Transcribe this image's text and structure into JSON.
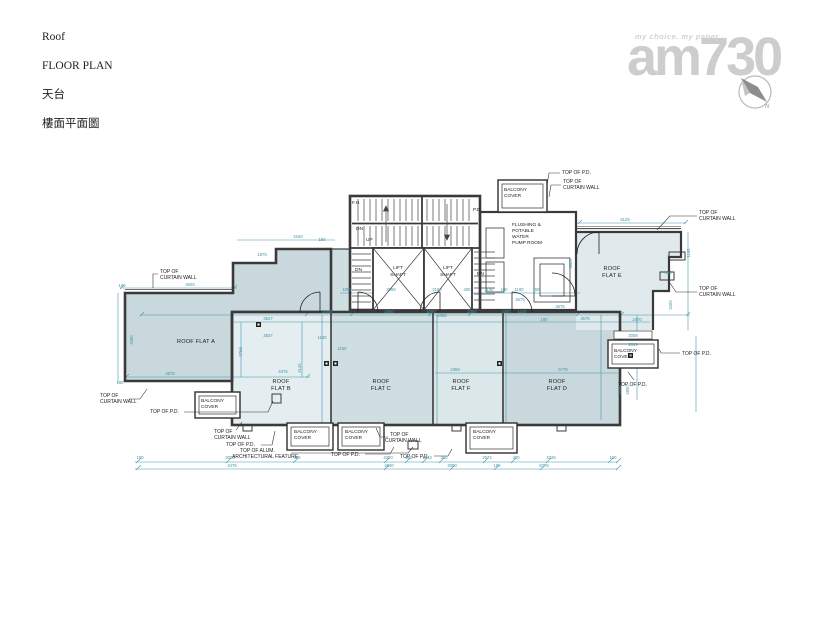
{
  "header": {
    "lines": [
      "Roof",
      "FLOOR PLAN",
      "天台",
      "樓面平面圖"
    ]
  },
  "watermark": {
    "tagline": "my choice. my paper",
    "brand": "am730",
    "compass_label": "N"
  },
  "labels": {
    "top_of_pd": "TOP OF P.D.",
    "top_of": "TOP OF",
    "curtain_wall": "CURTAIN WALL",
    "top_of_alum": "TOP OF ALUM.",
    "arch_feature": "ARCHITECTURAL FEATURE",
    "balcony": "BALCONY",
    "cover": "COVER",
    "lift": "LIFT",
    "shaft": "SHAFT",
    "dn": "DN",
    "up": "UP",
    "pd": "P.D.",
    "fh": "F.H.",
    "pump_room": [
      "FLUSHING &",
      "POTABLE",
      "WATER",
      "PUMP ROOM"
    ],
    "flat_a": "ROOF FLAT A",
    "roof": "ROOF",
    "flat_b": "FLAT B",
    "flat_c": "FLAT C",
    "flat_d": "FLAT D",
    "flat_e": "FLAT E",
    "flat_f": "FLAT F"
  },
  "colors": {
    "wall": "#3a3a3a",
    "dim": "#3f93a9",
    "fill_mid": "#c9d8dc",
    "fill_mid2": "#cfdee1",
    "fill_light": "#dce7ea",
    "fill_lighter": "#e4edef",
    "fill_e": "#e0eaec",
    "logo": "#cdcdcd"
  },
  "dims": [
    {
      "x": 190,
      "y": 286,
      "v": "4625"
    },
    {
      "x": 122,
      "y": 287,
      "v": "150"
    },
    {
      "x": 262,
      "y": 256,
      "v": "1875"
    },
    {
      "x": 298,
      "y": 238,
      "v": "2150"
    },
    {
      "x": 322,
      "y": 241,
      "v": "150"
    },
    {
      "x": 625,
      "y": 221,
      "v": "5125"
    },
    {
      "x": 347,
      "y": 291,
      "v": "1050"
    },
    {
      "x": 391,
      "y": 291,
      "v": "2050"
    },
    {
      "x": 437,
      "y": 291,
      "v": "2150"
    },
    {
      "x": 467,
      "y": 291,
      "v": "400"
    },
    {
      "x": 489,
      "y": 291,
      "v": "1100"
    },
    {
      "x": 504,
      "y": 291,
      "v": "100"
    },
    {
      "x": 519,
      "y": 291,
      "v": "1100"
    },
    {
      "x": 536,
      "y": 291,
      "v": "150"
    },
    {
      "x": 520,
      "y": 301,
      "v": "2675"
    },
    {
      "x": 560,
      "y": 308,
      "v": "4675"
    },
    {
      "x": 327,
      "y": 313,
      "v": "2088"
    },
    {
      "x": 389,
      "y": 313,
      "v": "3450"
    },
    {
      "x": 431,
      "y": 313,
      "v": "1000"
    },
    {
      "x": 472,
      "y": 313,
      "v": "3350"
    },
    {
      "x": 506,
      "y": 313,
      "v": "1000"
    },
    {
      "x": 522,
      "y": 313,
      "v": "1100"
    },
    {
      "x": 585,
      "y": 320,
      "v": "4575"
    },
    {
      "x": 544,
      "y": 321,
      "v": "100"
    },
    {
      "x": 268,
      "y": 320,
      "v": "3527"
    },
    {
      "x": 268,
      "y": 337,
      "v": "3537"
    },
    {
      "x": 170,
      "y": 375,
      "v": "4675"
    },
    {
      "x": 283,
      "y": 373,
      "v": "4475"
    },
    {
      "x": 301,
      "y": 368,
      "v": "4145",
      "r": 1
    },
    {
      "x": 242,
      "y": 352,
      "v": "2768",
      "r": 1
    },
    {
      "x": 133,
      "y": 340,
      "v": "4380",
      "r": 1
    },
    {
      "x": 120,
      "y": 384,
      "v": "150"
    },
    {
      "x": 322,
      "y": 339,
      "v": "1150"
    },
    {
      "x": 342,
      "y": 350,
      "v": "1150"
    },
    {
      "x": 637,
      "y": 321,
      "v": "2470"
    },
    {
      "x": 633,
      "y": 337,
      "v": "2008"
    },
    {
      "x": 633,
      "y": 346,
      "v": "2619"
    },
    {
      "x": 563,
      "y": 371,
      "v": "5775"
    },
    {
      "x": 455,
      "y": 371,
      "v": "2358"
    },
    {
      "x": 442,
      "y": 317,
      "v": "2358"
    },
    {
      "x": 572,
      "y": 264,
      "v": "3825",
      "r": 1
    },
    {
      "x": 672,
      "y": 305,
      "v": "3405",
      "r": 1
    },
    {
      "x": 690,
      "y": 253,
      "v": "1160",
      "r": 1
    },
    {
      "x": 668,
      "y": 274,
      "v": "456"
    },
    {
      "x": 621,
      "y": 390,
      "v": "3405",
      "r": 1
    },
    {
      "x": 629,
      "y": 390,
      "v": "4800",
      "r": 1
    },
    {
      "x": 140,
      "y": 459,
      "v": "150"
    },
    {
      "x": 230,
      "y": 459,
      "v": "4005"
    },
    {
      "x": 297,
      "y": 459,
      "v": "400"
    },
    {
      "x": 388,
      "y": 459,
      "v": "4300"
    },
    {
      "x": 409,
      "y": 459,
      "v": "150"
    },
    {
      "x": 427,
      "y": 459,
      "v": "1943"
    },
    {
      "x": 444,
      "y": 459,
      "v": "400"
    },
    {
      "x": 487,
      "y": 459,
      "v": "2572"
    },
    {
      "x": 516,
      "y": 459,
      "v": "400"
    },
    {
      "x": 551,
      "y": 459,
      "v": "4325"
    },
    {
      "x": 613,
      "y": 459,
      "v": "150"
    },
    {
      "x": 232,
      "y": 467,
      "v": "4475"
    },
    {
      "x": 389,
      "y": 467,
      "v": "4600"
    },
    {
      "x": 452,
      "y": 467,
      "v": "3050"
    },
    {
      "x": 497,
      "y": 467,
      "v": "100"
    },
    {
      "x": 544,
      "y": 467,
      "v": "5775"
    }
  ]
}
